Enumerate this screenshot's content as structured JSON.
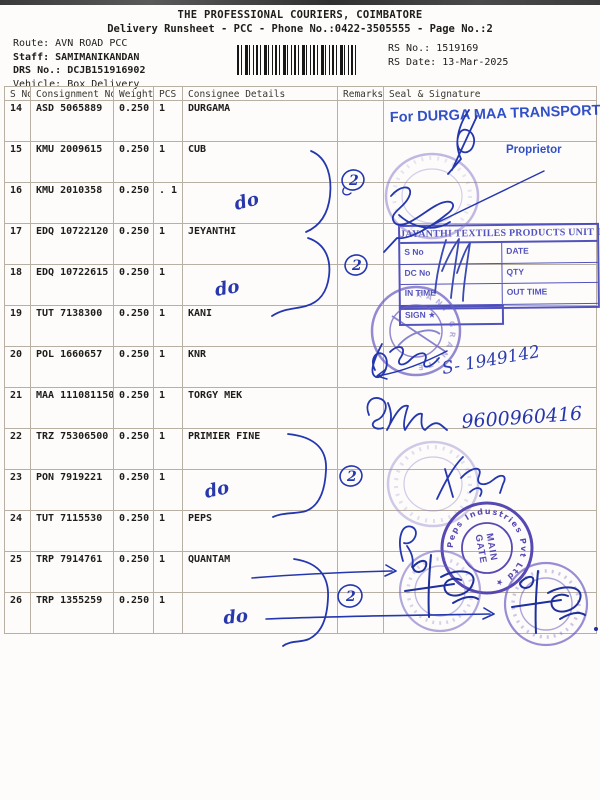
{
  "document": {
    "title": "THE PROFESSIONAL COURIERS, COIMBATORE",
    "subtitle": "Delivery Runsheet - PCC - Phone No.:0422-3505555 - Page No.:2"
  },
  "meta": {
    "route_label": "Route:",
    "route": "AVN ROAD PCC",
    "staff_label": "Staff:",
    "staff": "SAMIMANIKANDAN",
    "drs_label": "DRS No.:",
    "drs_no": "DCJB151916902",
    "vehicle_label": "Vehicle:",
    "vehicle": "Box Delivery",
    "rs_no_label": "RS No.:",
    "rs_no": "1519169",
    "rs_date_label": "RS Date:",
    "rs_date": "13-Mar-2025"
  },
  "table": {
    "columns": [
      "S No",
      "Consignment No",
      "Weight",
      "PCS",
      "Consignee Details",
      "Remarks",
      "Seal & Signature"
    ],
    "rows": [
      {
        "s_no": "14",
        "consignment_no": "ASD 5065889",
        "weight": "0.250",
        "pcs": "1",
        "consignee": "DURGAMA"
      },
      {
        "s_no": "15",
        "consignment_no": "KMU 2009615",
        "weight": "0.250",
        "pcs": "1",
        "consignee": "CUB"
      },
      {
        "s_no": "16",
        "consignment_no": "KMU 2010358",
        "weight": "0.250",
        "pcs": ". 1",
        "consignee": ""
      },
      {
        "s_no": "17",
        "consignment_no": "EDQ 10722120",
        "weight": "0.250",
        "pcs": "1",
        "consignee": "JEYANTHI"
      },
      {
        "s_no": "18",
        "consignment_no": "EDQ 10722615",
        "weight": "0.250",
        "pcs": "1",
        "consignee": ""
      },
      {
        "s_no": "19",
        "consignment_no": "TUT 7138300",
        "weight": "0.250",
        "pcs": "1",
        "consignee": "KANI"
      },
      {
        "s_no": "20",
        "consignment_no": "POL 1660657",
        "weight": "0.250",
        "pcs": "1",
        "consignee": "KNR"
      },
      {
        "s_no": "21",
        "consignment_no": "MAA 111081150",
        "weight": "0.250",
        "pcs": "1",
        "consignee": "TORGY MEK"
      },
      {
        "s_no": "22",
        "consignment_no": "TRZ 75306500",
        "weight": "0.250",
        "pcs": "1",
        "consignee": "PRIMIER FINE"
      },
      {
        "s_no": "23",
        "consignment_no": "PON 7919221",
        "weight": "0.250",
        "pcs": "1",
        "consignee": ""
      },
      {
        "s_no": "24",
        "consignment_no": "TUT 7115530",
        "weight": "0.250",
        "pcs": "1",
        "consignee": "PEPS"
      },
      {
        "s_no": "25",
        "consignment_no": "TRP 7914761",
        "weight": "0.250",
        "pcs": "1",
        "consignee": "QUANTAM"
      },
      {
        "s_no": "26",
        "consignment_no": "TRP 1355259",
        "weight": "0.250",
        "pcs": "1",
        "consignee": ""
      }
    ]
  },
  "annotations": {
    "durga_stamp": {
      "line1": "For DURGA MAA TRANSPORT",
      "line2": "Proprietor"
    },
    "jayanthi_stamp": {
      "title": "JAYANTHI TEXTILES PRODUCTS UNIT II",
      "s_no": "S No",
      "date": "DATE",
      "dc_no": "DC No",
      "qty": "QTY",
      "in_time": "IN TIME",
      "out_time": "OUT TIME",
      "sign": "SIGN ★"
    },
    "kani_stamp": {
      "ring_text": "KANI GRANITE"
    },
    "peps_stamp": {
      "ring_text": "Peps Industries Pvt Ltd ★",
      "center_top": "MAIN",
      "center_bottom": "GATE"
    },
    "handwritten": {
      "ditto": "do",
      "circled_count": "2",
      "sr_number": "S- 1949142",
      "phone": "9600960416"
    }
  }
}
